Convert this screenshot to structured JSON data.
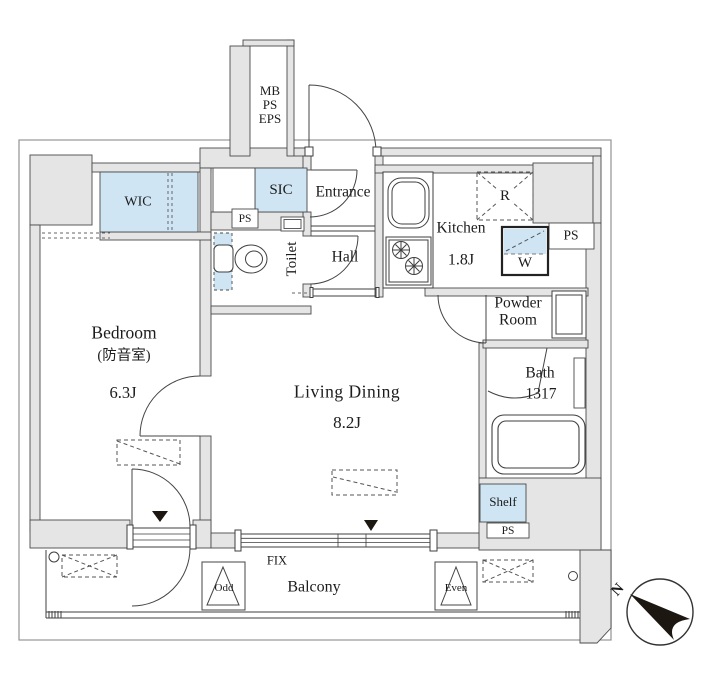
{
  "colors": {
    "wall_fill": "#e5e5e5",
    "fixture_fill": "#cfe5f4",
    "line": "#3f3f3f",
    "marker_black": "#1c1710"
  },
  "shaft": {
    "line1": "MB",
    "line2": "PS",
    "line3": "EPS"
  },
  "rooms": {
    "bedroom": {
      "name": "Bedroom",
      "note": "(防音室)",
      "area": "6.3J"
    },
    "living_dining": {
      "name": "Living Dining",
      "area": "8.2J"
    },
    "kitchen": {
      "name": "Kitchen",
      "area": "1.8J"
    },
    "entrance": {
      "name": "Entrance"
    },
    "hall": {
      "name": "Hall"
    },
    "toilet": {
      "name": "Toilet"
    },
    "powder_room": {
      "line1": "Powder",
      "line2": "Room"
    },
    "bath": {
      "name": "Bath",
      "size": "1317"
    },
    "balcony": {
      "name": "Balcony"
    }
  },
  "storage": {
    "wic": "WIC",
    "sic": "SIC",
    "shelf": "Shelf"
  },
  "equipment": {
    "fridge": "R",
    "washer": "W"
  },
  "pipe_spaces": {
    "entry": "PS",
    "kitchen_side": "PS",
    "bottom": "PS"
  },
  "window": {
    "fix": "FIX"
  },
  "floor_markers": {
    "odd": "Odd",
    "even": "Even"
  },
  "compass": {
    "north": "N"
  }
}
